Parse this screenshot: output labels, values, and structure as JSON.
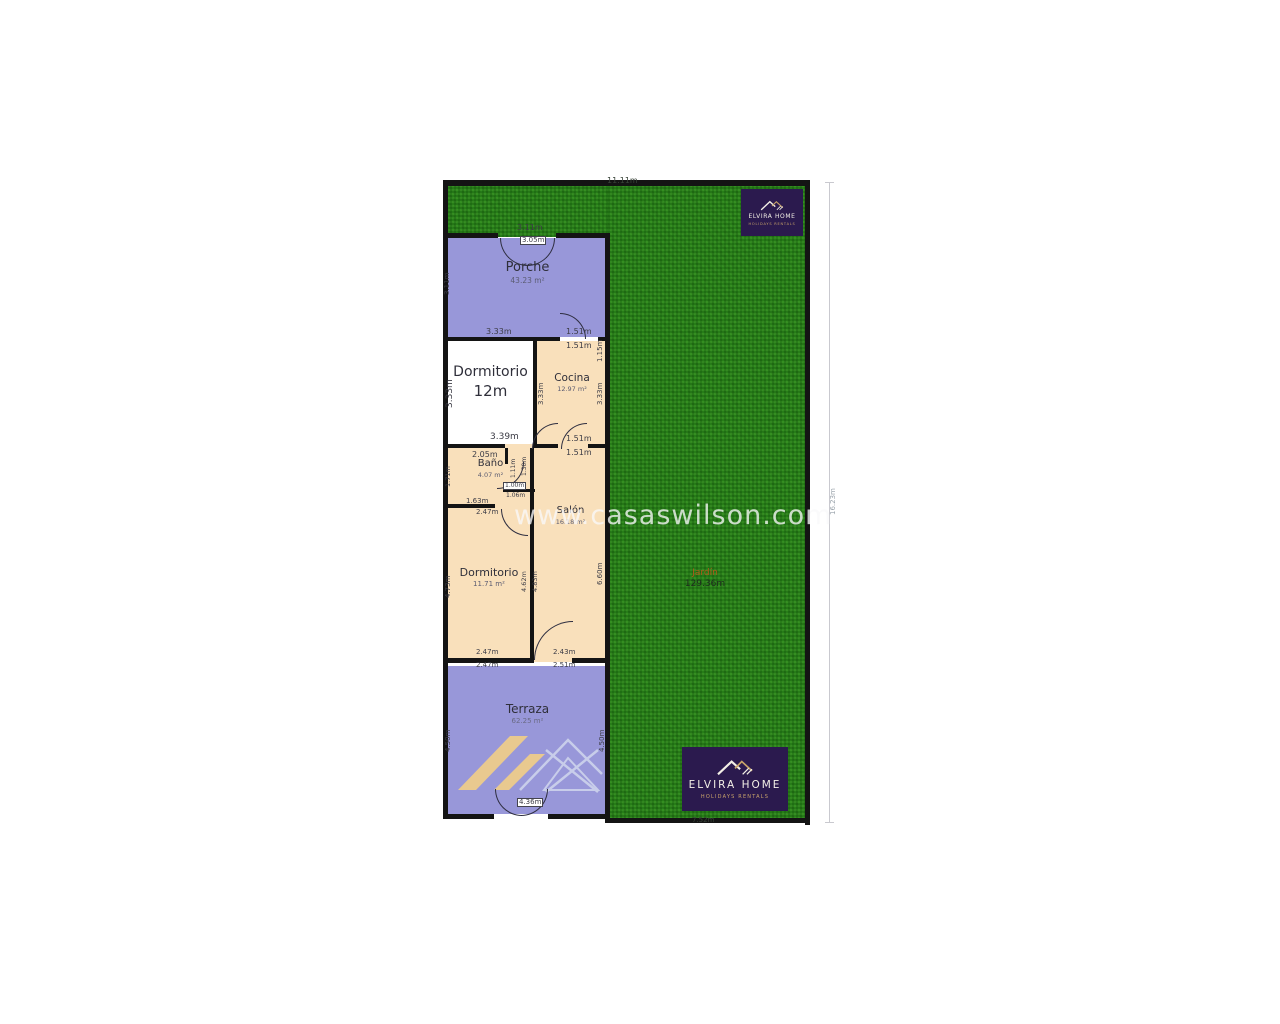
{
  "watermark": "www.casaswilson.com",
  "brand": {
    "name": "ELVIRA HOME",
    "subtitle": "HOLIDAYS RENTALS"
  },
  "rooms": {
    "porche": {
      "name": "Porche",
      "area": "43.23 m²"
    },
    "dormitorio1": {
      "name": "Dormitorio",
      "size": "12m"
    },
    "cocina": {
      "name": "Cocina",
      "area": "12.97 m²"
    },
    "bano": {
      "name": "Baño",
      "area": "4.07 m²"
    },
    "salon": {
      "name": "Salón",
      "area": "16.18 m²"
    },
    "dormitorio2": {
      "name": "Dormitorio",
      "area": "11.71 m²"
    },
    "terraza": {
      "name": "Terraza",
      "area": "62.25 m²"
    },
    "jardin": {
      "name": "Jardín",
      "area": "129.36m"
    }
  },
  "dims": {
    "top_width": "11.11m",
    "right_height": "16.23m",
    "garden_bottom": "7.52m",
    "porche_top": "3.11m",
    "porche_door": "3.05m",
    "porche_left": "3.11m",
    "porche_right": "1.15m",
    "porche_bottom_left": "3.33m",
    "porche_bottom_right": "1.51m",
    "cocina_top": "1.51m",
    "dorm1_left": "3.33m",
    "dorm1_bottom": "3.39m",
    "cocina_left": "3.33m",
    "cocina_right": "3.33m",
    "cocina_bottom_a": "1.51m",
    "cocina_bottom_b": "1.51m",
    "bano_top": "2.05m",
    "bano_left": "1.71m",
    "bano_inner_v1": "1.11m",
    "bano_inner_v2": "1.30m",
    "bano_inner_h1": "1.00m",
    "bano_inner_h2": "1.06m",
    "bano_bottom": "1.63m",
    "dorm2_top": "2.47m",
    "dorm2_left": "4.73m",
    "wall_mid_a": "4.62m",
    "wall_mid_b": "4.83m",
    "salon_right": "6.60m",
    "dorm2_bottom_a": "2.47m",
    "salon_bottom_a": "2.43m",
    "dorm2_bottom_b": "2.47m",
    "salon_bottom_b": "2.51m",
    "terraza_left": "4.50m",
    "terraza_right": "4.50m",
    "terraza_door": "4.36m"
  },
  "colors": {
    "grass": "#2e8a1d",
    "room_purple": "#9897d9",
    "room_tan": "#f9e0bb",
    "room_white": "#ffffff",
    "wall": "#141414",
    "logo_bg": "#2b1a4e",
    "logo_gold": "#c9a46a",
    "garden_label_orange": "#b05a1a",
    "watermark": "#f8f8fa"
  }
}
